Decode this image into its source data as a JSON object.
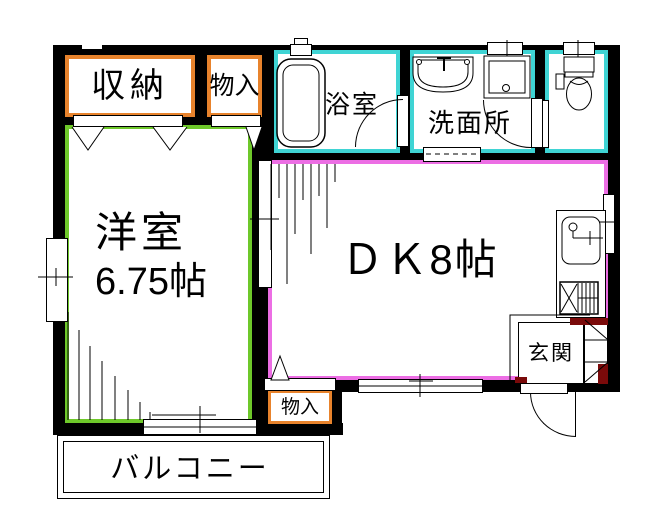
{
  "title": "apartment-floorplan-1dk",
  "rooms": {
    "western_room": {
      "label": "洋室",
      "size": "6.75帖"
    },
    "dk": {
      "label": "ＤＫ8帖"
    },
    "bathroom": {
      "label": "浴室"
    },
    "washroom": {
      "label": "洗面所"
    },
    "toilet": {
      "label": ""
    },
    "entrance": {
      "label": "玄関"
    },
    "balcony": {
      "label": "バルコニー"
    },
    "storage": {
      "label": "収納"
    },
    "closet_top": {
      "label": "物入"
    },
    "closet_bottom": {
      "label": "物入"
    }
  },
  "colors": {
    "wall": "#000000",
    "western_room_border": "#6ec82a",
    "dk_border": "#ec6ee4",
    "wet_area_border": "#3fd4d4",
    "storage_border": "#e8832c",
    "entrance_accent": "#7a0a0a"
  },
  "icons": [
    "bathtub-icon",
    "wash-basin-icon",
    "washing-machine-pan-icon",
    "toilet-icon",
    "kitchen-sink-icon",
    "gas-stove-icon",
    "shoe-cabinet-icon",
    "entrance-door-icon",
    "bath-door-icon",
    "washroom-door-icon",
    "sliding-door-icon",
    "folding-door-icon",
    "window-icon",
    "hatch-lines-icon"
  ]
}
